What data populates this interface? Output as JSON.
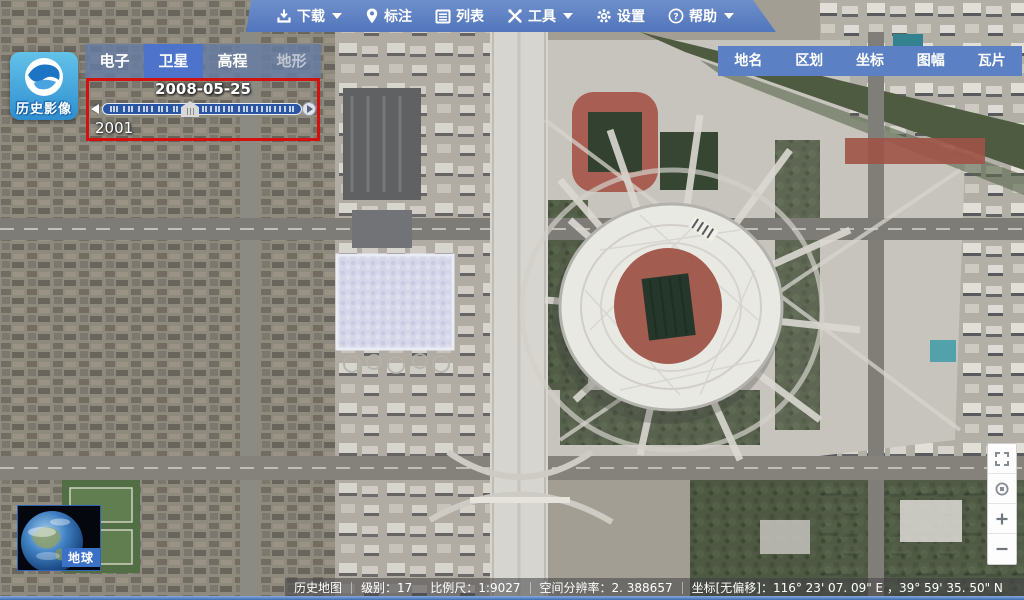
{
  "app": {
    "logo_label": "历史影像"
  },
  "colors": {
    "toolbar_blue": "#5b80c3",
    "tab_active_blue": "#4d74ca",
    "highlight_red": "#d41111",
    "slider_track_blue": "#2a55a2",
    "status_bg": "rgba(66,66,70,0.55)"
  },
  "toolbar": {
    "items": [
      {
        "label": "下载",
        "icon": "download-icon",
        "has_dropdown": true
      },
      {
        "label": "标注",
        "icon": "pin-icon",
        "has_dropdown": false
      },
      {
        "label": "列表",
        "icon": "list-icon",
        "has_dropdown": false
      },
      {
        "label": "工具",
        "icon": "tools-icon",
        "has_dropdown": true
      },
      {
        "label": "设置",
        "icon": "gear-icon",
        "has_dropdown": false
      },
      {
        "label": "帮助",
        "icon": "help-icon",
        "has_dropdown": true
      }
    ]
  },
  "layer_tabs": {
    "items": [
      {
        "label": "电子",
        "state": "normal"
      },
      {
        "label": "卫星",
        "state": "active"
      },
      {
        "label": "高程",
        "state": "normal"
      },
      {
        "label": "地形",
        "state": "muted"
      }
    ]
  },
  "timeline": {
    "current_date": "2008-05-25",
    "start_year": "2001"
  },
  "overlay_buttons": [
    "地名",
    "区划",
    "坐标",
    "图幅",
    "瓦片"
  ],
  "map_controls": [
    "fullscreen-icon",
    "center-target-icon",
    "zoom-in-icon",
    "zoom-out-icon"
  ],
  "globe": {
    "label": "地球"
  },
  "status_bar": {
    "map_name": "历史地图",
    "level": "级别：17",
    "scale": "比例尺：1:9027",
    "resolution": "空间分辨率：2. 388657",
    "coordinates": "坐标[无偏移]：116° 23' 07. 09\" E ，39° 59' 35. 50\" N"
  }
}
